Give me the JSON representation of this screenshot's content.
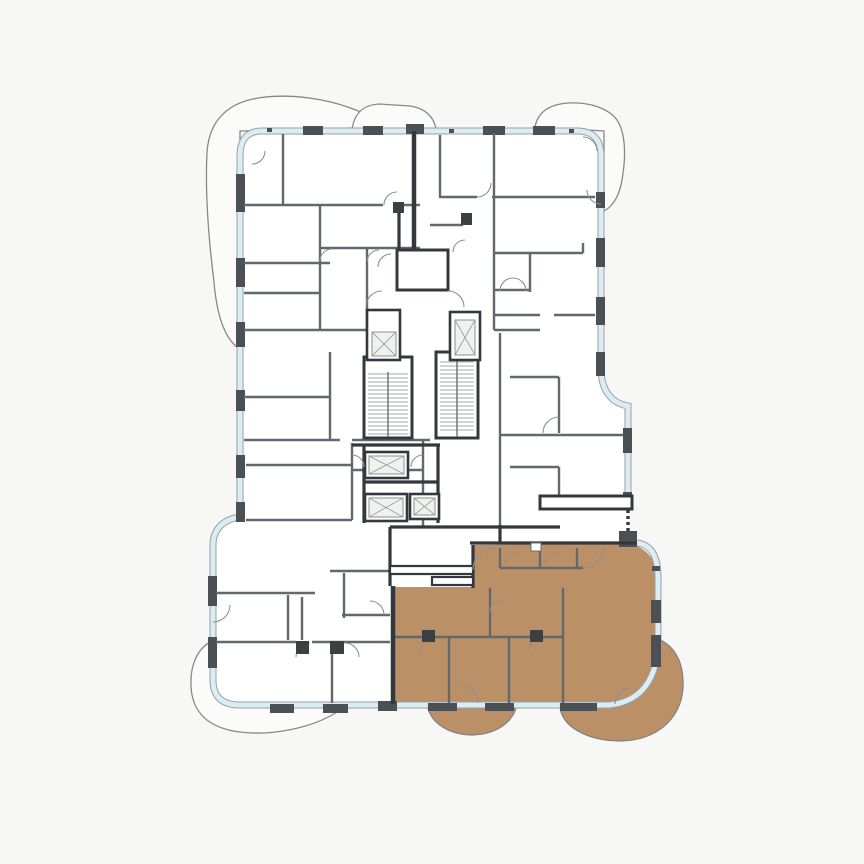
{
  "plan": {
    "type": "residential-floor-plan",
    "highlighted_unit": {
      "position": "bottom-right",
      "status_color": "#bc9067"
    },
    "core": {
      "stair_shafts": 2,
      "elevator_shafts": 5
    },
    "balconies": {
      "outline_only": 4,
      "unit_highlighted": 2
    }
  },
  "colors": {
    "background": "#f7f7f5",
    "floor": "#ffffff",
    "glazing": "#daecf4",
    "glazing_edge": "#9aa0a4",
    "wall_dark": "#34383c",
    "wall_partition": "#63686c",
    "mullion": "#4b5054",
    "unit_highlight": "#bc9067",
    "balcony_outline": "#85898c",
    "door_arc": "#8b9094"
  }
}
